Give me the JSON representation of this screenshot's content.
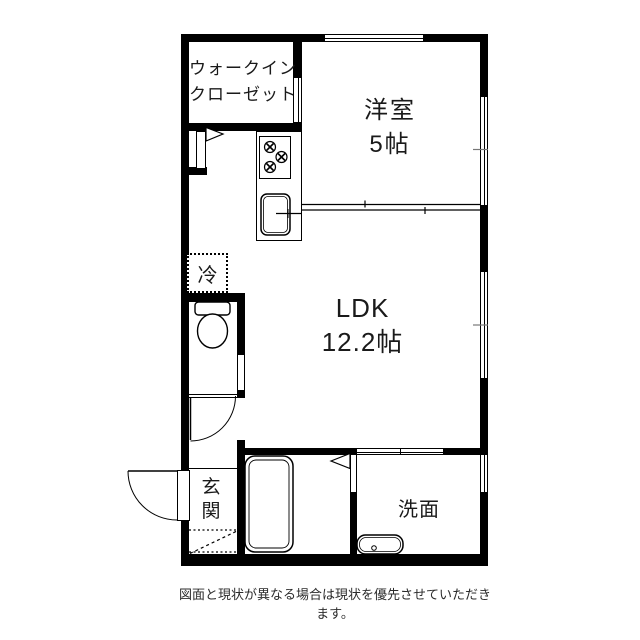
{
  "document": {
    "type": "floor-plan",
    "background": "#ffffff"
  },
  "colors": {
    "wall": "#000000",
    "text": "#1a1a1a",
    "footer_text": "#2b2b2b"
  },
  "rooms": {
    "walkin_closet": {
      "label_line1": "ウォークイン",
      "label_line2": "クローゼット"
    },
    "western_room": {
      "name": "洋室",
      "size": "5帖"
    },
    "ldk": {
      "name": "LDK",
      "size": "12.2帖"
    },
    "entrance": {
      "char1": "玄",
      "char2": "関"
    },
    "washroom": {
      "name": "洗面"
    },
    "refrigerator": {
      "label": "冷"
    }
  },
  "icons": {
    "toilet": "toilet-icon",
    "bathtub": "bathtub-icon",
    "washbasin": "washbasin-icon",
    "stove": "stove-burners-icon",
    "sink": "kitchen-sink-icon",
    "fridge_box": "fridge-dashed-box",
    "hall_door": "door-swing-arc",
    "entrance_door": "entrance-door-arc",
    "closet_door_marker": "door-triangle-icon",
    "bath_door_marker": "door-triangle-icon"
  },
  "footer": {
    "disclaimer": "図面と現状が異なる場合は現状を優先させていただきます。"
  }
}
